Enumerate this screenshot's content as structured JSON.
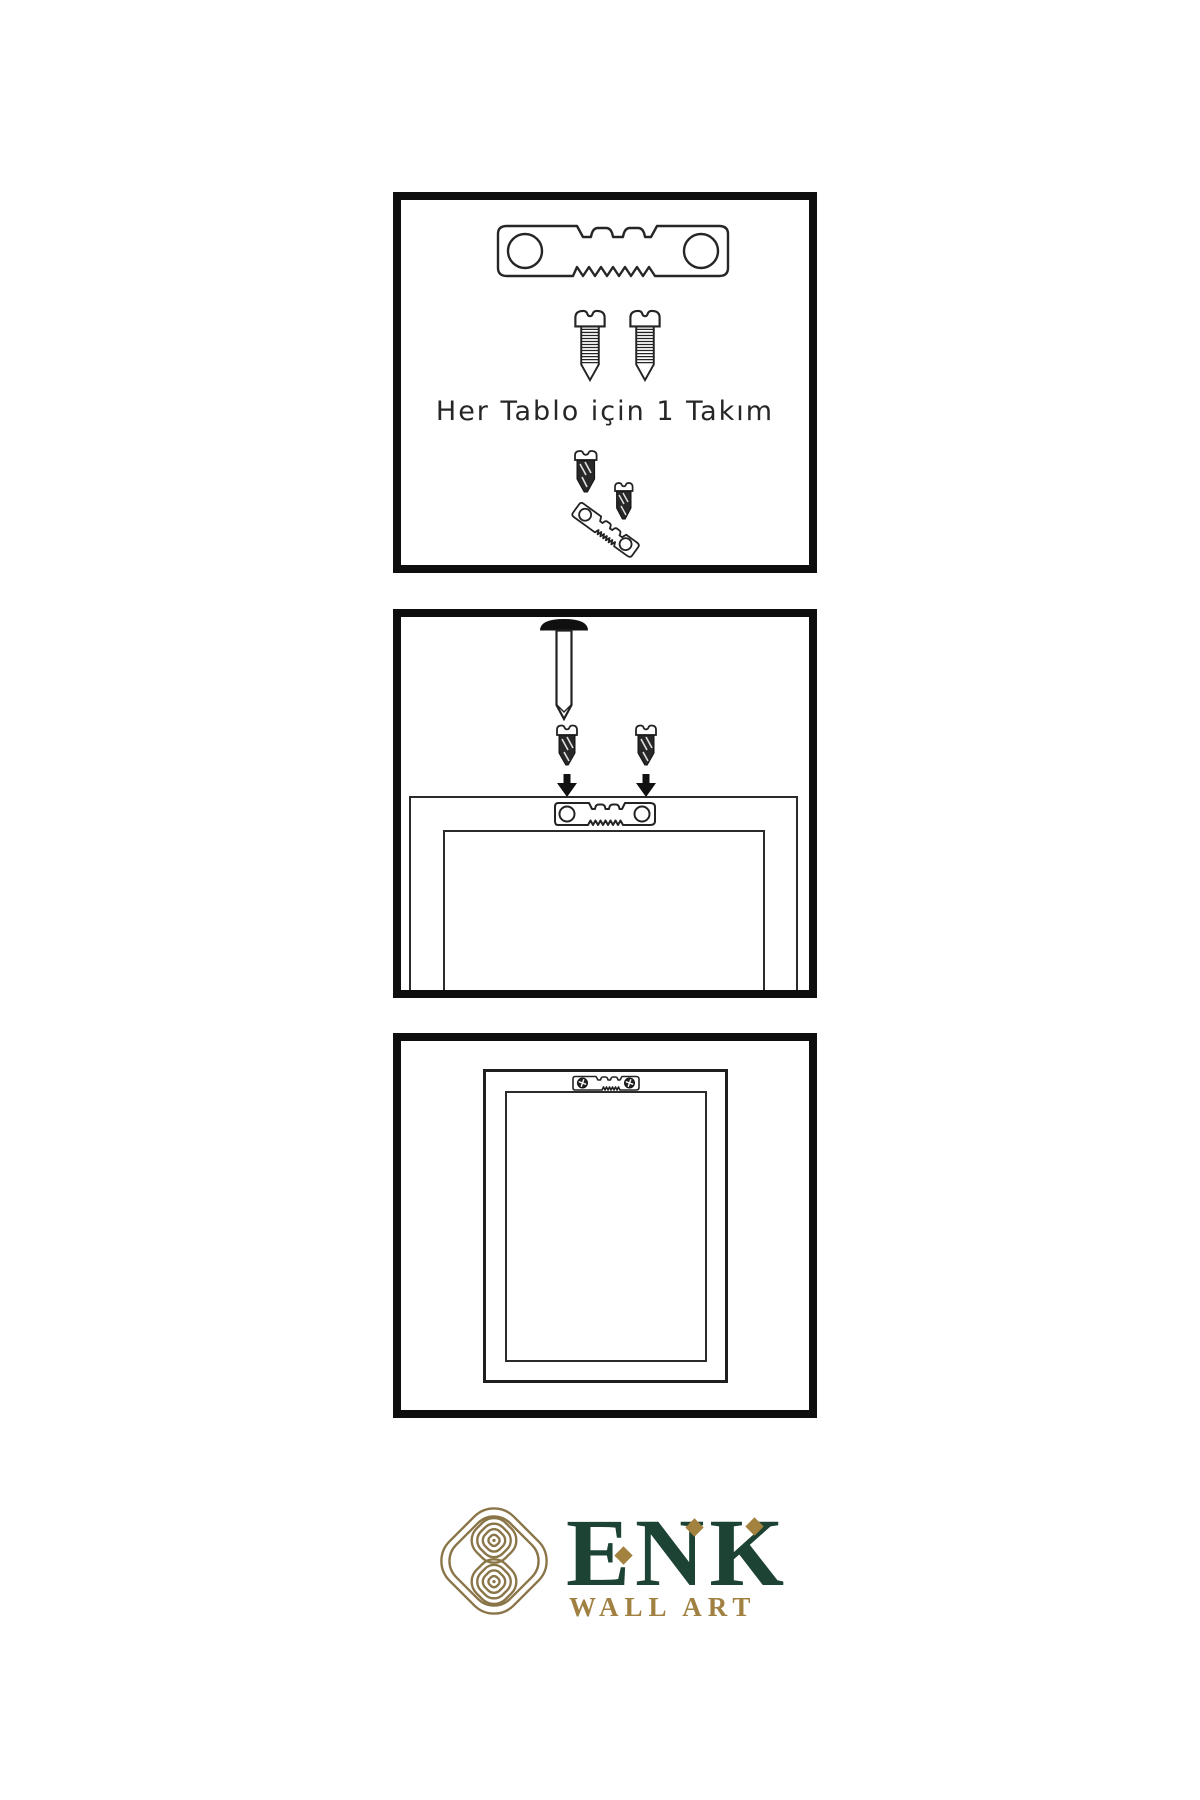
{
  "colors": {
    "background": "#ffffff",
    "diagram_line": "#262626",
    "panel_border": "#0e0e0e",
    "dark_hardware": "#282828",
    "logo_green": "#1d4334",
    "logo_gold": "#a18142",
    "knot_gold": "#8a7548"
  },
  "steps": {
    "step1": {
      "caption": "Her Tablo için 1 Takım",
      "icons": [
        "sawtooth-hanger-icon",
        "screw-icon",
        "screw-icon",
        "screw-into-hanger-icon"
      ]
    },
    "step2": {
      "icons": [
        "wall-nail-icon",
        "screw-down-arrow-icon",
        "screw-down-arrow-icon",
        "frame-back-with-hanger-icon"
      ]
    },
    "step3": {
      "icons": [
        "hung-frame-with-hanger-icon"
      ]
    }
  },
  "brand": {
    "name": "ENK",
    "tagline": "WALL ART",
    "logo_icon": "knot-logo-icon"
  }
}
